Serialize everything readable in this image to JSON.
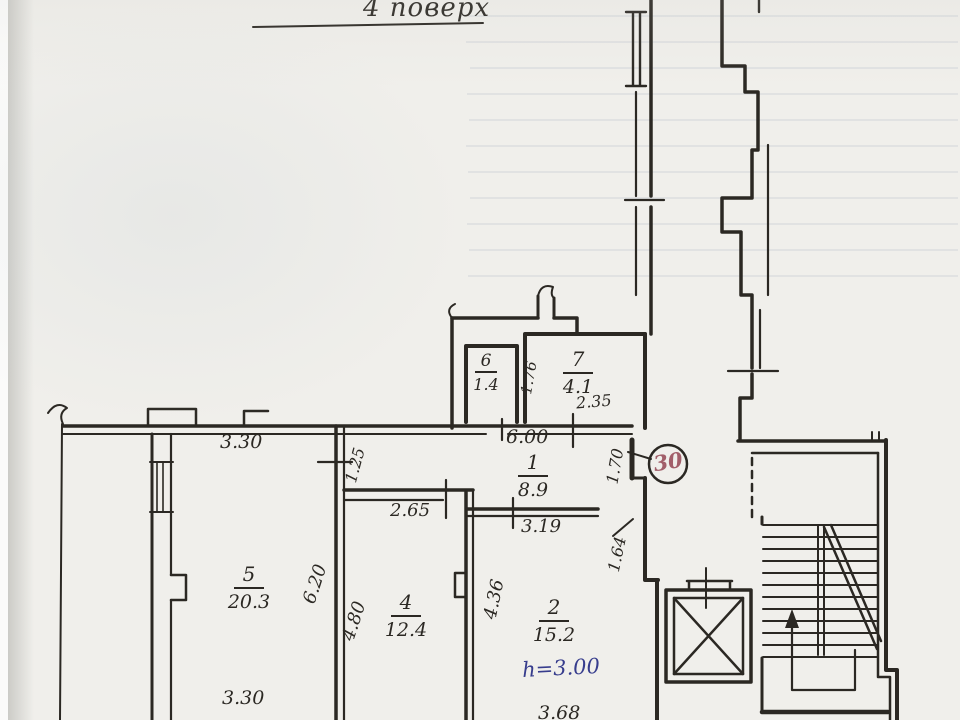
{
  "page": {
    "title": "4 поверх"
  },
  "unit_badge": {
    "number": "30"
  },
  "rooms": {
    "r1": {
      "number": "1",
      "area": "8.9"
    },
    "r2": {
      "number": "2",
      "area": "15.2",
      "height_note": "h=3.00"
    },
    "r4": {
      "number": "4",
      "area": "12.4"
    },
    "r5": {
      "number": "5",
      "area": "20.3"
    },
    "r6": {
      "number": "6",
      "area": "1.4"
    },
    "r7": {
      "number": "7",
      "area": "4.1"
    }
  },
  "dimensions": {
    "room5_width_top": "3.30",
    "room5_width_bottom": "3.30",
    "room5_height": "6.20",
    "corridor_niche": "1.25",
    "room4_width": "2.65",
    "room4_height": "4.80",
    "room2_height_left": "4.36",
    "hall_width": "6.00",
    "hall_bottom": "3.19",
    "entry_side": "1.70",
    "lobby_side": "1.64",
    "room7_left": "1.76",
    "room7_bottom": "2.35",
    "room2_width": "3.68"
  },
  "colors": {
    "ink": "#2b2823",
    "badge_red": "#a25f6a",
    "note_blue": "#373d8d",
    "paper": "#f0efeb"
  }
}
